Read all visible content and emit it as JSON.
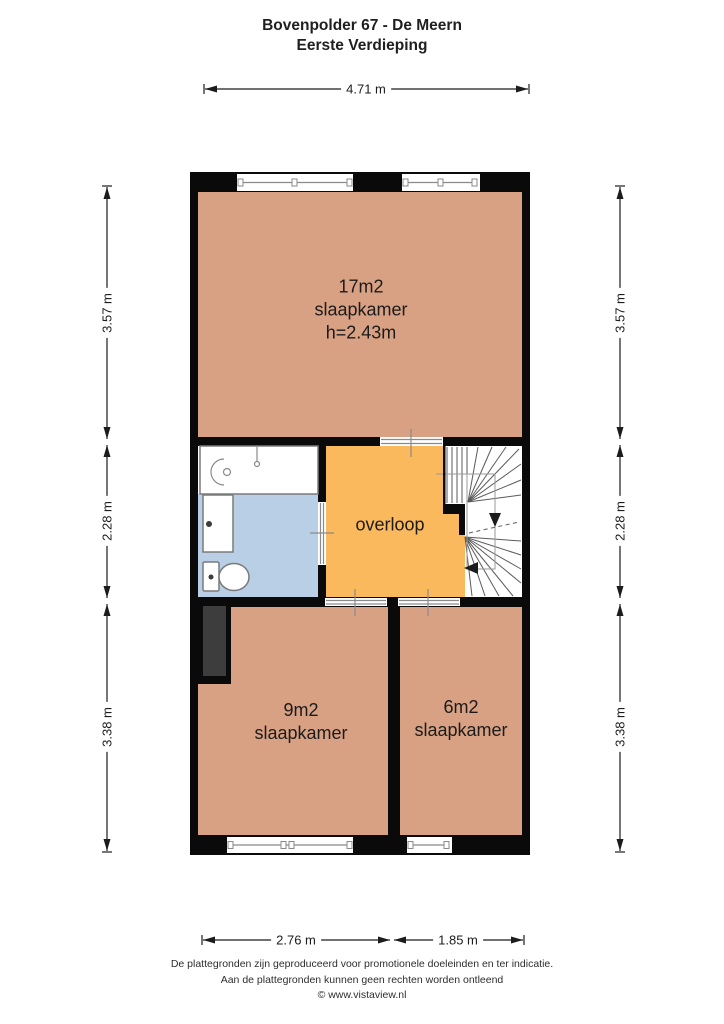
{
  "header": {
    "title": "Bovenpolder 67 - De Meern",
    "subtitle": "Eerste Verdieping"
  },
  "rooms": {
    "bedroom_large": {
      "area": "17m2",
      "label": "slaapkamer",
      "ceiling_height": "h=2.43m"
    },
    "landing": {
      "label": "overloop"
    },
    "bedroom_medium": {
      "area": "9m2",
      "label": "slaapkamer"
    },
    "bedroom_small": {
      "area": "6m2",
      "label": "slaapkamer"
    }
  },
  "dimensions": {
    "top_width": "4.71 m",
    "left_top": "3.57 m",
    "left_middle": "2.28 m",
    "left_bottom": "3.38 m",
    "right_top": "3.57 m",
    "right_middle": "2.28 m",
    "right_bottom": "3.38 m",
    "bottom_left": "2.76 m",
    "bottom_right": "1.85 m"
  },
  "footer": {
    "line1": "De plattegronden zijn geproduceerd voor promotionele doeleinden en ter indicatie.",
    "line2": "Aan de plattegronden kunnen geen rechten worden ontleend",
    "line3": "© www.vistaview.nl"
  },
  "colors": {
    "wall": "#0a0a0a",
    "room_fill": "#d9a183",
    "landing_fill": "#f9b95c",
    "bathroom_fill": "#b8cfe6",
    "duct_fill": "#3d3d3d"
  }
}
